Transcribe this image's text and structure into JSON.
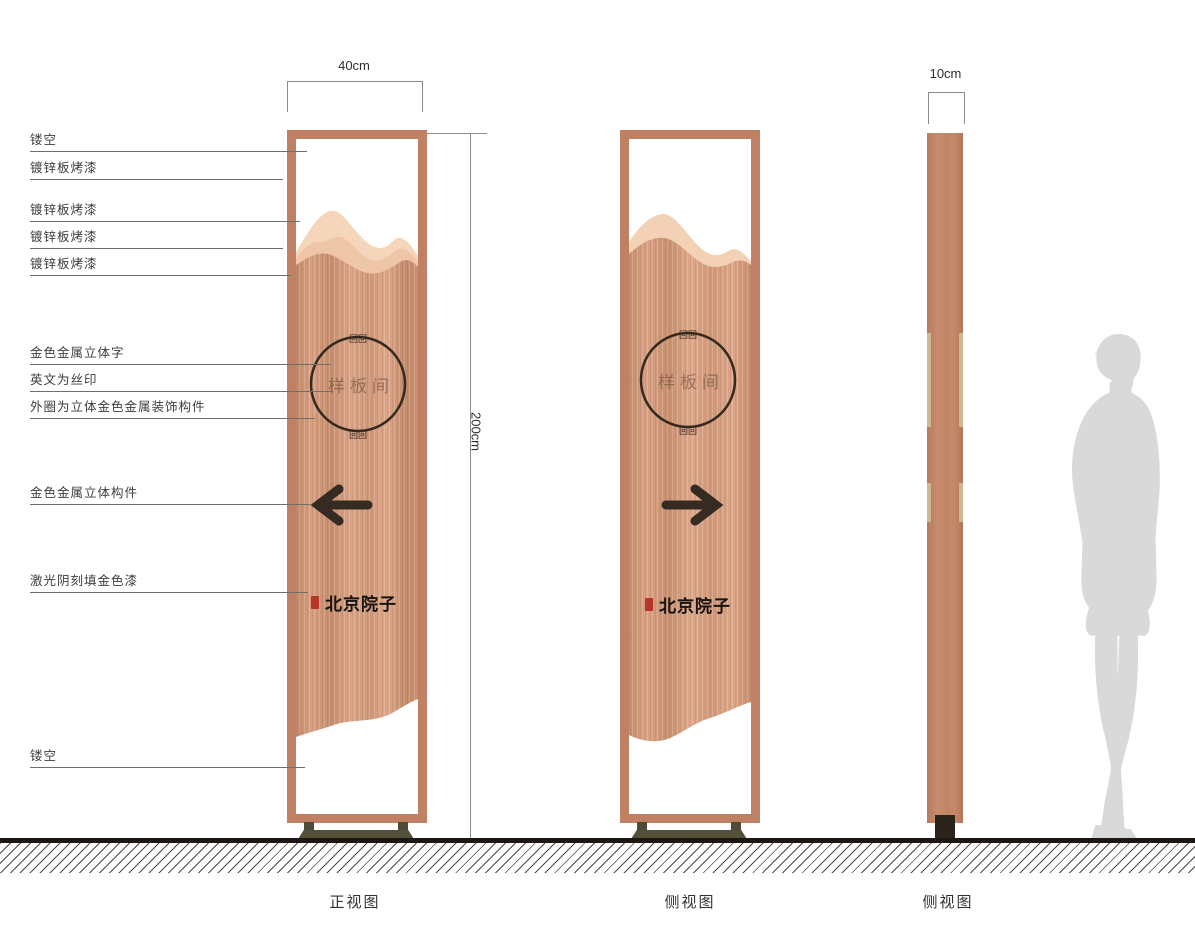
{
  "annotations": {
    "left": [
      {
        "text": "镂空"
      },
      {
        "text": "镀锌板烤漆"
      },
      {
        "text": "镀锌板烤漆"
      },
      {
        "text": "镀锌板烤漆"
      },
      {
        "text": "镀锌板烤漆"
      },
      {
        "text": "金色金属立体字"
      },
      {
        "text": "英文为丝印"
      },
      {
        "text": "外圈为立体金色金属装饰构件"
      },
      {
        "text": "金色金属立体构件"
      },
      {
        "text": "激光阴刻填金色漆"
      },
      {
        "text": "镂空"
      }
    ]
  },
  "dimensions": {
    "front_width": "40cm",
    "height": "200cm",
    "side_width": "10cm"
  },
  "signage": {
    "room_label": "样板间",
    "brand": "北京院子",
    "ornament_glyph": "回回"
  },
  "views": [
    {
      "label": "正视图"
    },
    {
      "label": "侧视图"
    },
    {
      "label": "侧视图"
    }
  ],
  "colors": {
    "frame_copper": "#c08064",
    "mountain_light": "#f5d6ba",
    "mountain_mid": "#eec5a6",
    "body_copper": "#cf9778",
    "line_dark": "#33291f",
    "pedestal": "#52503a",
    "seal_red": "#b5352b",
    "silhouette_gray": "#d9d9d9"
  }
}
